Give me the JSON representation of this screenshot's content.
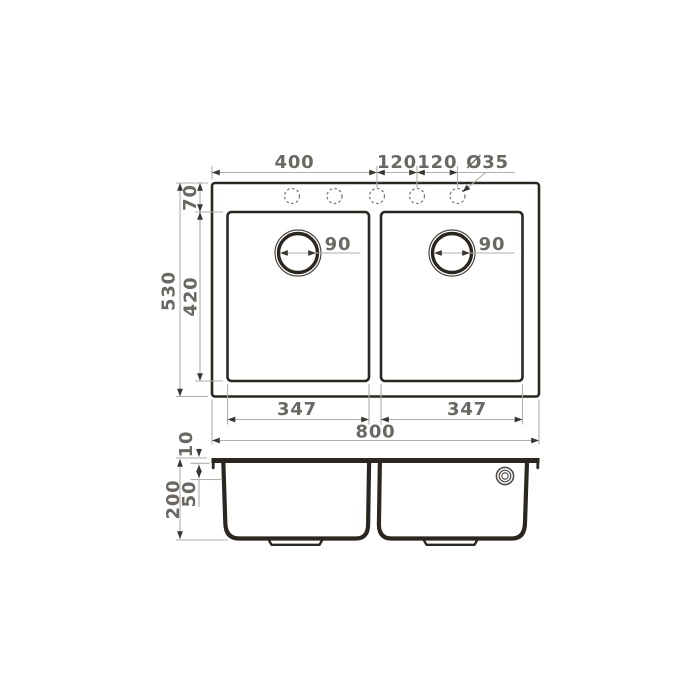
{
  "title": "Double-bowl sink dimension drawing (top view and section view)",
  "colors": {
    "outline": "#2b261f",
    "dimension_line": "#b2afaa",
    "arrow": "#3a3631",
    "label_text": "#6b6762",
    "dashed_hole": "#807c76",
    "background": "#ffffff"
  },
  "top_view": {
    "faucet_hole_count": 5,
    "labels": {
      "offset_400": "400",
      "pitch_a": "120",
      "pitch_b": "120",
      "hole_dia": "Ø35",
      "edge_70": "70",
      "length_530": "530",
      "bowl_length_420": "420",
      "drain_left_90": "90",
      "drain_right_90": "90",
      "bowl_width_left_347": "347",
      "bowl_width_right_347": "347",
      "overall_width_800": "800"
    }
  },
  "side_view": {
    "labels": {
      "rim_10": "10",
      "upper_50": "50",
      "depth_200": "200"
    }
  }
}
